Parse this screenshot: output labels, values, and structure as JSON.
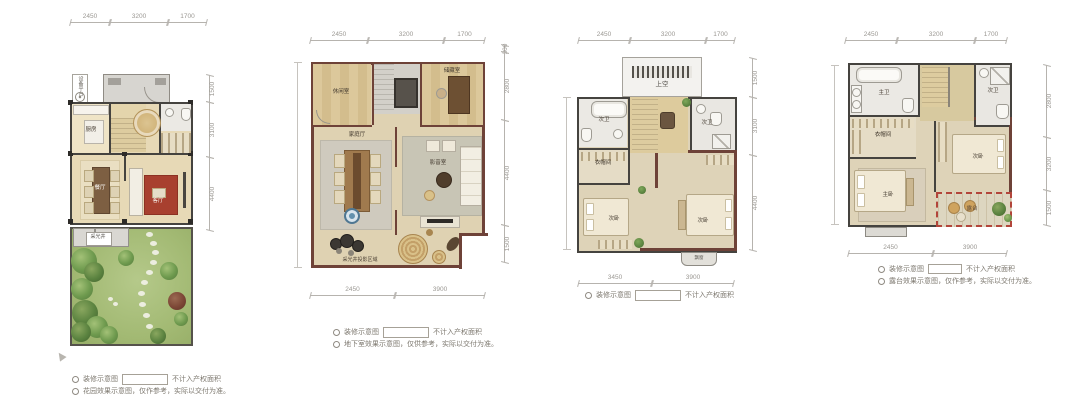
{
  "colors": {
    "wall_dark": "#45433f",
    "wall_maroon": "#6e4238",
    "wood_floor": "#e2d2ab",
    "gray_floor": "#cdcac2",
    "lawn_green": "#a7bd79",
    "rug_red": "#a8402f",
    "terrace_dash_red": "#b2453a",
    "dim_gray": "#9b9893"
  },
  "plans": [
    {
      "dims_top": [
        "2450",
        "3200",
        "1700"
      ],
      "dims_right": [
        "1500",
        "3100",
        "4400"
      ],
      "rooms": {
        "equipment": "设备平台",
        "kitchen": "厨房",
        "dining": "餐厅",
        "living": "客厅",
        "lightwell": "采光井"
      },
      "legend": [
        {
          "label": "装修示意图",
          "note": "不计入产权面积"
        },
        {
          "label": "花园效果示意图，仅作参考，实际以交付为准。"
        }
      ]
    },
    {
      "dims_top": [
        "2450",
        "3200",
        "1700"
      ],
      "dims_right": [
        "300",
        "2800",
        "4400",
        "1500"
      ],
      "dims_bottom": [
        "2450",
        "3900"
      ],
      "rooms": {
        "room_a": "休闲室",
        "room_b": "储藏室",
        "family": "家庭厅",
        "av": "影音室",
        "note": "采光井投影区域"
      },
      "legend": [
        {
          "label": "装修示意图",
          "note": "不计入产权面积"
        },
        {
          "label": "地下室效果示意图，仅供参考，实际以交付为准。"
        }
      ]
    },
    {
      "dims_top": [
        "2450",
        "3200",
        "1700"
      ],
      "dims_right": [
        "1500",
        "3100",
        "4400"
      ],
      "dims_bottom": [
        "3450",
        "3900"
      ],
      "rooms": {
        "void": "上空",
        "bath_left": "次卫",
        "bath_right": "次卫",
        "closet": "衣帽间",
        "bed_left": "次卧",
        "bed_right": "次卧",
        "bay": "飘窗"
      },
      "legend": [
        {
          "label": "装修示意图",
          "note": "不计入产权面积"
        }
      ]
    },
    {
      "dims_top": [
        "2450",
        "3200",
        "1700"
      ],
      "dims_right": [
        "2800",
        "3200",
        "1500"
      ],
      "dims_bottom": [
        "2450",
        "3900"
      ],
      "rooms": {
        "bath_master": "主卫",
        "bath_second": "次卫",
        "closet": "衣帽间",
        "bed_master": "主卧",
        "bed_second": "次卧",
        "terrace": "露台"
      },
      "legend": [
        {
          "label": "装修示意图",
          "note": "不计入产权面积"
        },
        {
          "label": "露台效果示意图，仅作参考，实际以交付为准。"
        }
      ]
    }
  ]
}
